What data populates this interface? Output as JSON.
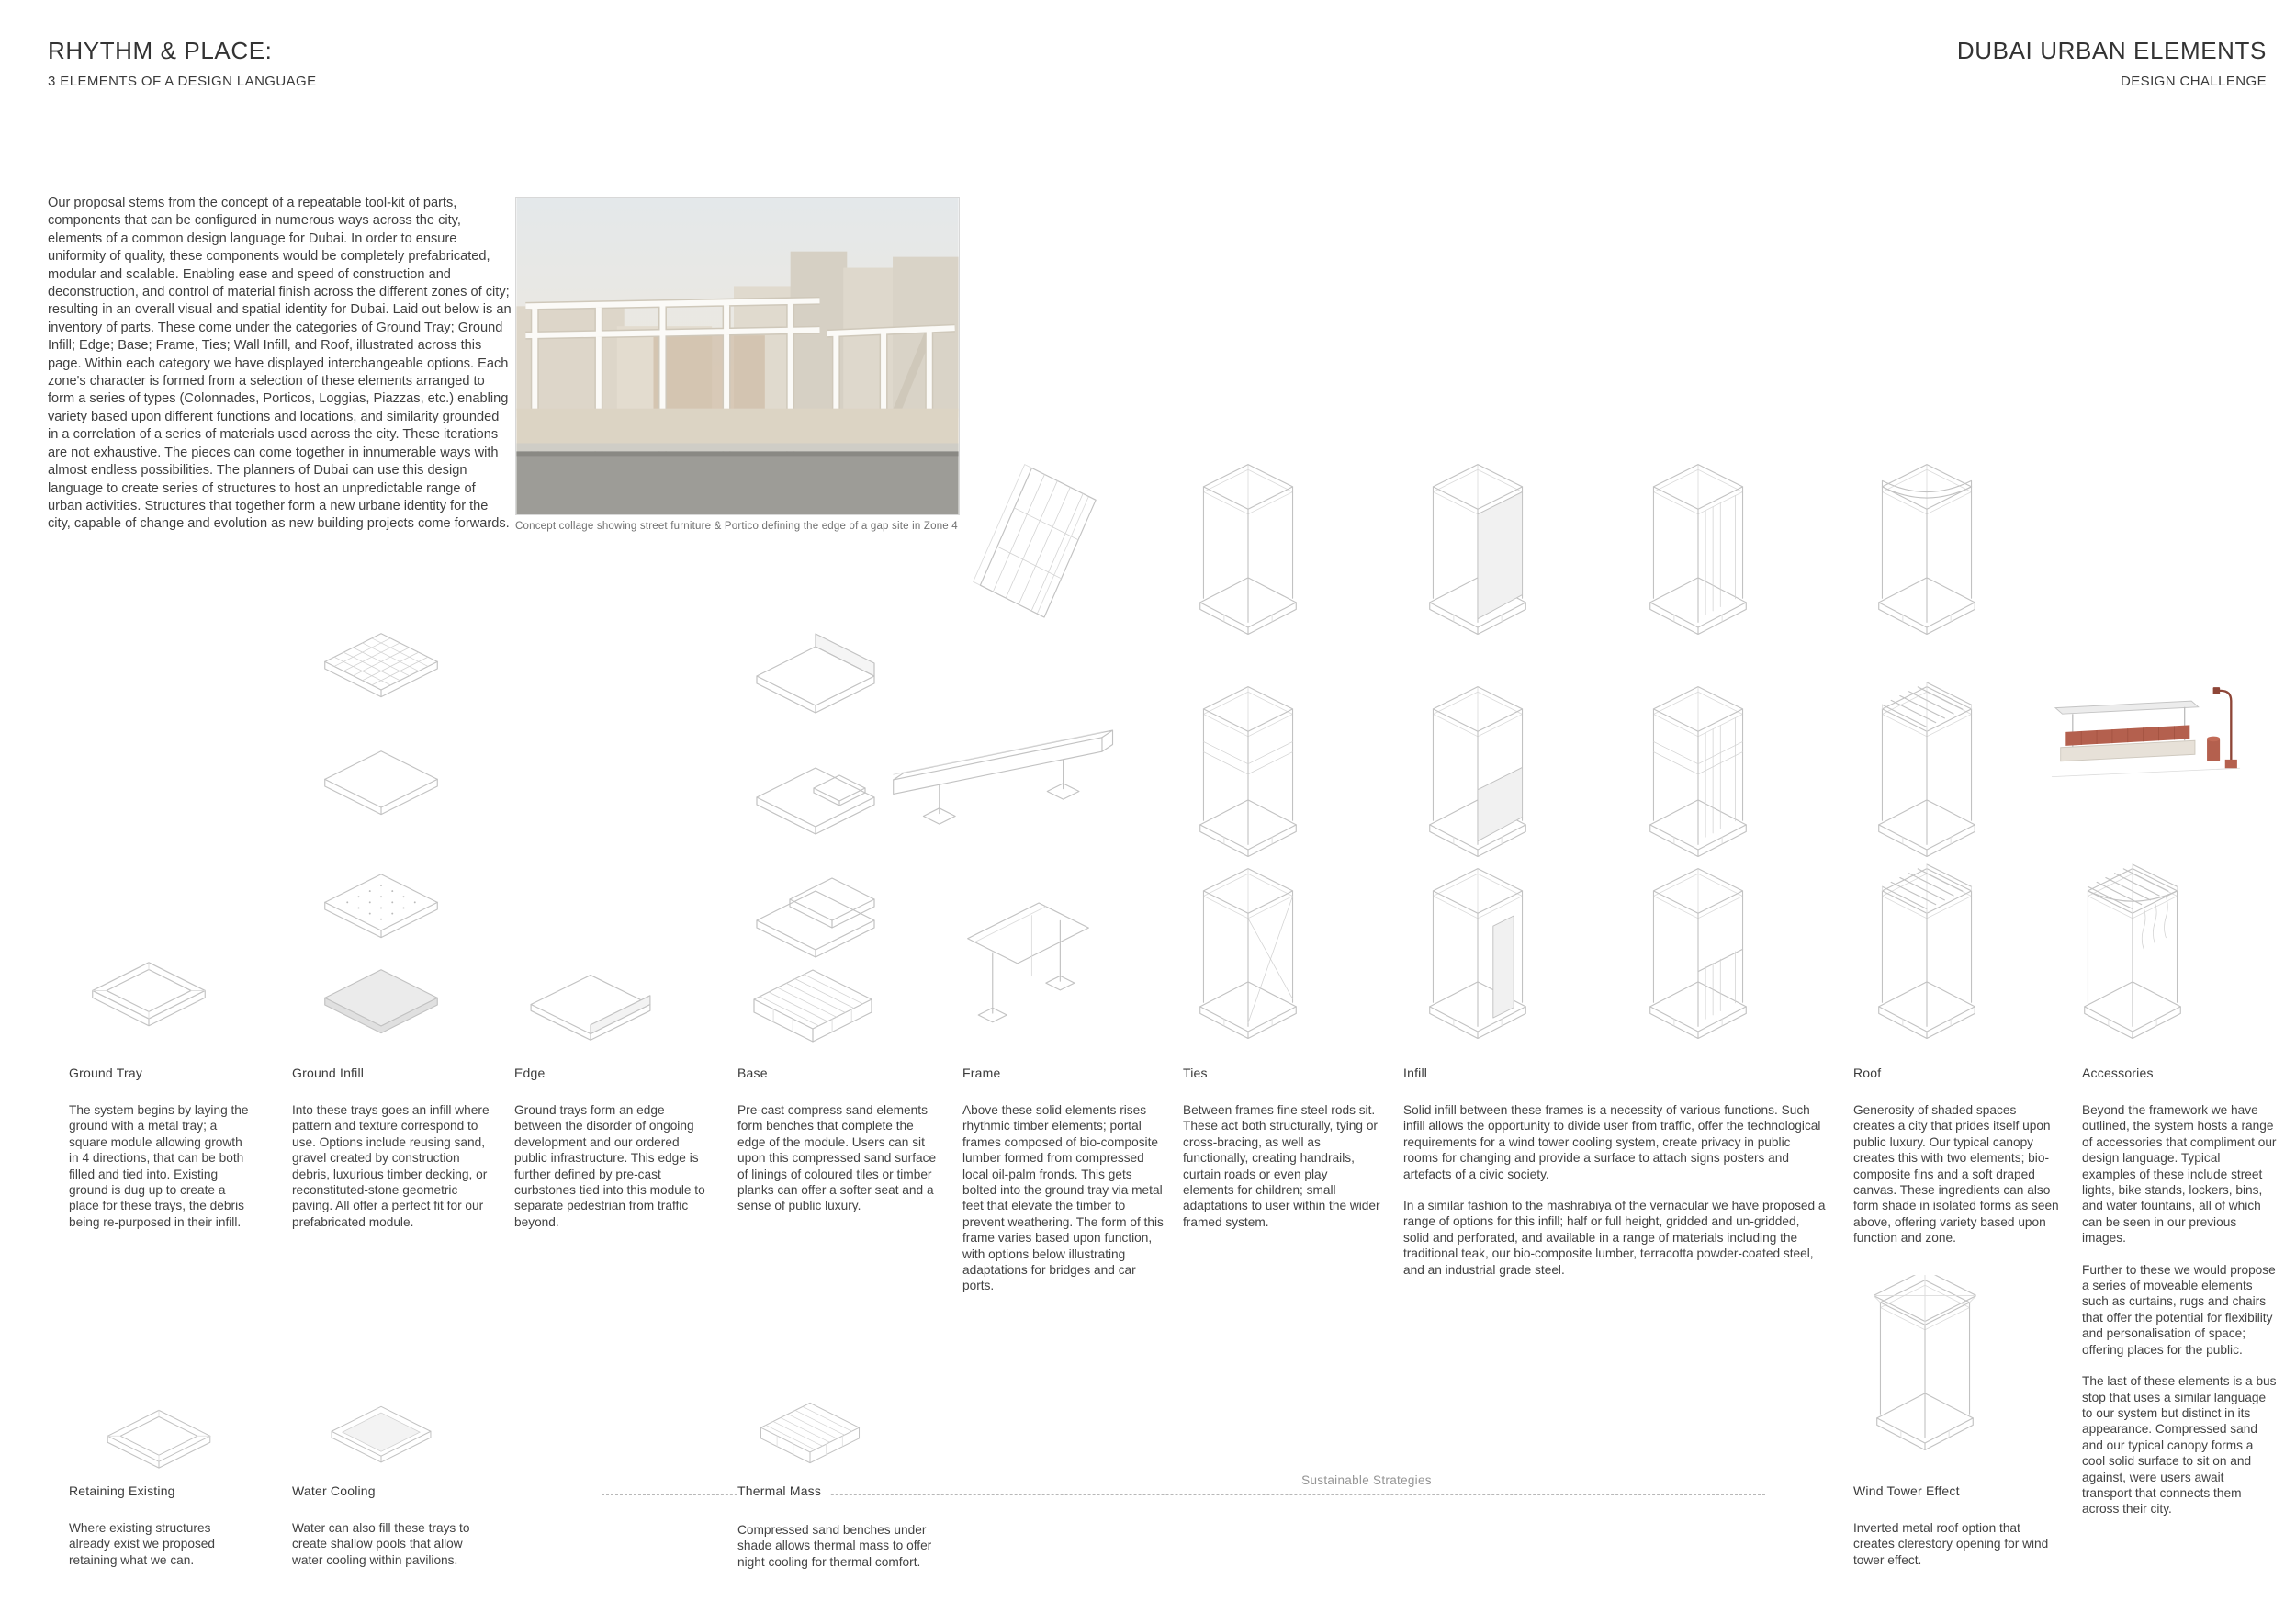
{
  "header": {
    "title": "RHYTHM & PLACE:",
    "subtitle": "3 ELEMENTS OF A DESIGN LANGUAGE",
    "right_title": "DUBAI URBAN ELEMENTS",
    "right_subtitle": "DESIGN CHALLENGE"
  },
  "intro": "Our proposal stems from the concept of a repeatable  tool-kit of parts, components that can be configured in numerous ways across the city, elements of a common design language for Dubai. In order to ensure uniformity of quality, these components would be completely prefabricated, modular and scalable. Enabling ease and speed of construction and deconstruction, and control of material finish across the different zones of city; resulting in an overall visual and spatial identity for Dubai. Laid out below is an inventory of parts. These come under the categories of Ground Tray; Ground Infill; Edge; Base; Frame, Ties; Wall Infill,  and Roof, illustrated across this page. Within each category we have displayed interchangeable options. Each zone's character is formed from a selection of these elements arranged to form a series of types (Colonnades, Porticos, Loggias, Piazzas, etc.) enabling variety based upon different functions and locations, and similarity grounded in a correlation of a series of materials used across the city. These iterations are not exhaustive. The pieces can come together in innumerable ways with almost endless possibilities. The planners of Dubai can use this design language to create series of structures to host an unpredictable range of urban activities. Structures that together form a new urbane identity for the city, capable of change and evolution as new building projects come forwards.",
  "collage_caption": "Concept collage showing street furniture &  Portico defining the edge of a gap site in Zone 4",
  "categories": [
    {
      "label": "Ground Tray",
      "p1": "The system begins by laying the ground with a metal tray; a square module allowing growth in 4 directions, that can be both filled and tied into. Existing ground is dug up to create a place for these trays, the debris being re-purposed in their infill."
    },
    {
      "label": "Ground Infill",
      "p1": "Into these trays goes an infill where pattern and texture correspond to use. Options include reusing sand, gravel created by construction debris, luxurious timber decking, or reconstituted-stone geometric paving. All offer a perfect fit for our prefabricated module."
    },
    {
      "label": "Edge",
      "p1": "Ground trays form an edge between the disorder of ongoing development and our ordered public infrastructure. This edge is further defined by pre-cast curbstones tied into this module to separate pedestrian from traffic beyond."
    },
    {
      "label": "Base",
      "p1": "Pre-cast compress sand elements form benches that complete the edge of the module. Users can sit upon this compressed sand surface of linings of coloured tiles or timber planks can offer a softer seat and a sense of public luxury."
    },
    {
      "label": "Frame",
      "p1": "Above these solid elements rises rhythmic timber elements; portal frames composed of bio-composite lumber formed from compressed local oil-palm fronds. This gets bolted into the ground tray via metal feet that elevate the timber to prevent weathering. The form of this frame varies based upon function, with options below illustrating adaptations for bridges and car ports."
    },
    {
      "label": "Ties",
      "p1": "Between frames fine steel rods sit. These act both structurally, tying or cross-bracing, as well as functionally, creating handrails, curtain roads or even play elements for children; small adaptations to user within the wider framed system."
    },
    {
      "label": "Infill",
      "p1": "Solid infill between these frames is a necessity of various functions. Such infill allows the opportunity to divide user from traffic, offer the technological requirements for a wind tower cooling system, create privacy in public rooms for changing and provide a surface to attach signs posters and artefacts of a civic society.",
      "p2": "In a similar fashion to the mashrabiya of the vernacular we have proposed a range of options for this infill; half or full height, gridded and un-gridded, solid and perforated, and available in a range of materials including the traditional teak, our bio-composite lumber, terracotta powder-coated steel, and an industrial grade steel."
    },
    {
      "label": "Roof",
      "p1": "Generosity of shaded spaces creates a city that prides itself upon public luxury. Our typical canopy creates this with two elements; bio-composite fins and a soft draped canvas. These ingredients can also form shade in isolated forms as seen above, offering variety based upon function and zone."
    },
    {
      "label": "Accessories",
      "p1": "Beyond the framework we have outlined, the system hosts a range of accessories that compliment our design language. Typical examples of these include street lights, bike stands, lockers, bins, and water fountains, all of which can be seen in our previous images.",
      "p2": "Further to these we would propose a series of moveable elements such as curtains, rugs and chairs that offer the potential for flexibility and personalisation of space; offering places for the public.",
      "p3": "The last of these elements is a bus stop that uses a similar language to our system but distinct in its appearance. Compressed sand and our typical canopy forms a cool solid surface to sit on and against, were users await transport that connects them across their city."
    }
  ],
  "strategies": {
    "section_label": "Sustainable Strategies",
    "items": [
      {
        "label": "Retaining Existing",
        "p1": "Where existing structures already exist we proposed retaining what we can."
      },
      {
        "label": "Water Cooling",
        "p1": "Water can also fill these trays to create shallow pools that allow water cooling within pavilions."
      },
      {
        "label": "Thermal Mass",
        "p1": "Compressed sand benches under shade allows thermal mass to offer night cooling for thermal comfort."
      },
      {
        "label": "Wind Tower Effect",
        "p1": "Inverted metal roof option that creates clerestory opening for wind tower effect."
      }
    ]
  },
  "colors": {
    "accent_terracotta": "#b4604e",
    "line_gray": "#c2c2c2",
    "page_bg": "#ffffff"
  }
}
